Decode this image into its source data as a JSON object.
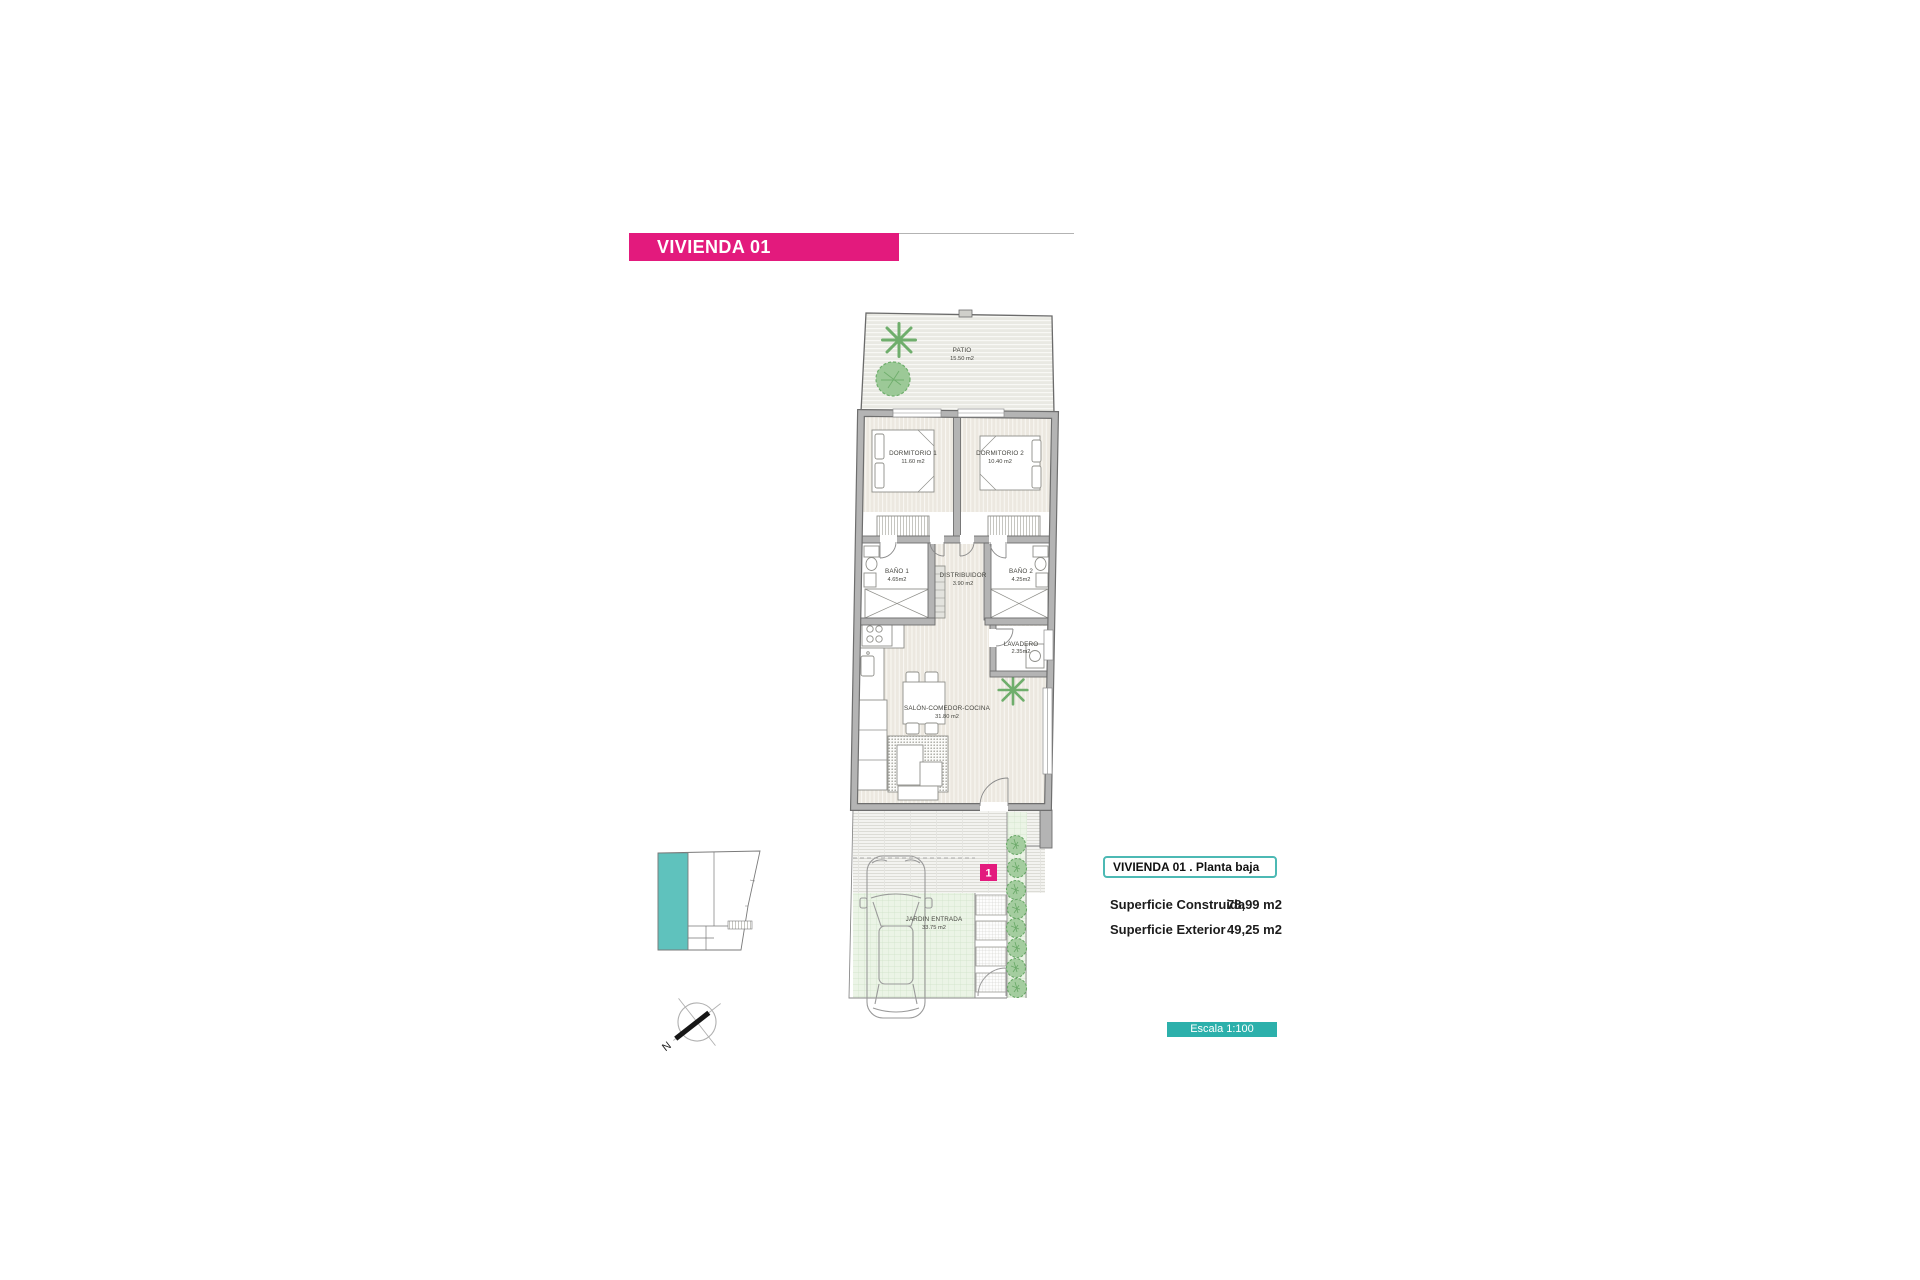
{
  "header": {
    "title": "VIVIENDA 01"
  },
  "floor_plan": {
    "rooms": [
      {
        "name": "PATIO",
        "area": "15.50 m2"
      },
      {
        "name": "DORMITORIO 1",
        "area": "11.60 m2"
      },
      {
        "name": "DORMITORIO 2",
        "area": "10.40 m2"
      },
      {
        "name": "BAÑO 1",
        "area": "4.65m2"
      },
      {
        "name": "BAÑO 2",
        "area": "4.25m2"
      },
      {
        "name": "DISTRIBUIDOR",
        "area": "3.90 m2"
      },
      {
        "name": "LAVADERO",
        "area": "2.35m2"
      },
      {
        "name": "SALÓN-COMEDOR-COCINA",
        "area": "31.80 m2"
      },
      {
        "name": "JARDIN ENTRADA",
        "area": "33.75 m2"
      }
    ],
    "unit_marker": "1"
  },
  "info_panel": {
    "title": "VIVIENDA 01 .  Planta baja",
    "rows": [
      {
        "label": "Superficie Construida",
        "value": "78,99 m2"
      },
      {
        "label": "Superficie Exterior",
        "value": "49,25 m2"
      }
    ]
  },
  "scale_label": "Escala 1:100",
  "compass": {
    "north_label": "N"
  },
  "colors": {
    "accent_pink": "#e31a7d",
    "accent_teal": "#2cb0ab"
  }
}
